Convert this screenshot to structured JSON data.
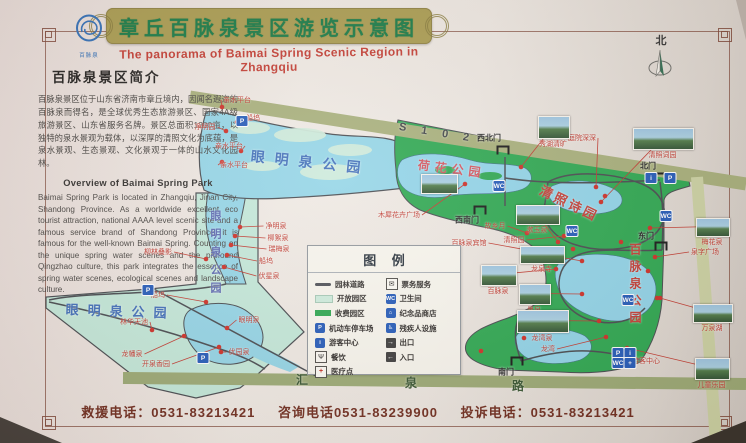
{
  "title": {
    "cn": "章丘百脉泉景区游览示意图",
    "en": "The panorama of Baimai Spring Scenic Region in Zhangqiu"
  },
  "logo": {
    "text": "百脉泉"
  },
  "compass": {
    "label": "北"
  },
  "intro": {
    "heading": "百脉泉景区简介",
    "cn_text": "百脉泉景区位于山东省济南市章丘境内，因闻名遐迩的百脉泉而得名，是全球优秀生态旅游景区、国家4A级旅游景区、山东省服务名牌。景区总面积1300亩，以独特的泉水景观为载体，以深厚的清照文化为底蕴，是泉水景观、生态景观、文化景观于一体的山水文化园林。",
    "en_heading": "Overview of Baimai Spring Park",
    "en_text": "Baimai Spring Park is located in Zhangqiu, Jinan City, Shandong Province. As a worldwide excellent eco tourist attraction, national AAAA level scenic site and a famous service brand of Shandong Province, it is famous for the well-known Baimai Spring. Counting on the unique spring water scenes and the profound Qingzhao culture, this park integrates the essence of spring water scenes, ecological scenes and landscape culture."
  },
  "legend": {
    "title": "图 例",
    "left": [
      {
        "icon": "garden-road-icon",
        "kind": "road",
        "glyph": "",
        "label": "园林道路"
      },
      {
        "icon": "open-area-icon",
        "kind": "open",
        "glyph": "",
        "label": "开放园区"
      },
      {
        "icon": "paid-area-icon",
        "kind": "paid",
        "glyph": "",
        "label": "收费园区"
      },
      {
        "icon": "parking-icon",
        "kind": "blue",
        "glyph": "P",
        "label": "机动车停车场"
      },
      {
        "icon": "visitor-center-icon",
        "kind": "blue",
        "glyph": "i",
        "label": "游客中心"
      },
      {
        "icon": "food-icon",
        "kind": "plain",
        "glyph": "Ψ",
        "label": "餐饮"
      },
      {
        "icon": "medical-icon",
        "kind": "plain med",
        "glyph": "+",
        "label": "医疗点"
      }
    ],
    "right": [
      {
        "icon": "ticket-icon",
        "kind": "plain",
        "glyph": "✉",
        "label": "票务服务"
      },
      {
        "icon": "toilet-icon",
        "kind": "blue",
        "glyph": "WC",
        "label": "卫生间"
      },
      {
        "icon": "souvenir-shop-icon",
        "kind": "blue",
        "glyph": "⌂",
        "label": "纪念品商店"
      },
      {
        "icon": "accessible-icon",
        "kind": "blue",
        "glyph": "♿",
        "label": "残疾人设施"
      },
      {
        "icon": "exit-icon",
        "kind": "door",
        "glyph": "→",
        "label": "出口"
      },
      {
        "icon": "entrance-icon",
        "kind": "door",
        "glyph": "←",
        "label": "入口"
      }
    ]
  },
  "map": {
    "texts": [
      {
        "t": "眼明泉公园",
        "x": 252,
        "y": 146,
        "size": 14,
        "color": "#3f6db8",
        "sp": 10,
        "rot": 6
      },
      {
        "t": "眼明泉公园",
        "x": 207,
        "y": 210,
        "size": 11,
        "color": "#5a67b0",
        "sp": 7,
        "vert": true
      },
      {
        "t": "眼明泉公园",
        "x": 66,
        "y": 299,
        "size": 13,
        "color": "#3f6db8",
        "sp": 9,
        "rot": 2
      },
      {
        "t": "荷花公园",
        "x": 419,
        "y": 156,
        "size": 12,
        "color": "#d4525c",
        "sp": 5,
        "rot": 7
      },
      {
        "t": "清照诗园",
        "x": 545,
        "y": 180,
        "size": 13,
        "color": "#c23b33",
        "sp": 3,
        "rot": 26
      },
      {
        "t": "百脉泉公园",
        "x": 627,
        "y": 243,
        "size": 12,
        "color": "#c23b33",
        "sp": 5,
        "vert": true
      },
      {
        "t": "S 1 0 2",
        "x": 400,
        "y": 121,
        "size": 11,
        "color": "#3e4245",
        "sp": 6,
        "rot": 9
      },
      {
        "t": "汇",
        "x": 296,
        "y": 371,
        "size": 12,
        "color": "#34522e"
      },
      {
        "t": "泉",
        "x": 405,
        "y": 374,
        "size": 12,
        "color": "#34522e"
      },
      {
        "t": "路",
        "x": 512,
        "y": 377,
        "size": 12,
        "color": "#34522e"
      }
    ],
    "gates": [
      {
        "label": "西北门",
        "x": 503,
        "y": 150,
        "lx": 489,
        "ly": 138
      },
      {
        "label": "北门",
        "x": 662,
        "y": 177,
        "lx": 648,
        "ly": 166
      },
      {
        "label": "东门",
        "x": 661,
        "y": 246,
        "lx": 646,
        "ly": 236
      },
      {
        "label": "西南门",
        "x": 480,
        "y": 210,
        "lx": 467,
        "ly": 220
      },
      {
        "label": "南门",
        "x": 517,
        "y": 361,
        "lx": 506,
        "ly": 372
      }
    ],
    "spots": [
      {
        "label": "亲水平台",
        "lx": 237,
        "ly": 100,
        "dx": 222,
        "dy": 107
      },
      {
        "label": "船坞",
        "lx": 253,
        "ly": 118,
        "dx": 237,
        "dy": 122
      },
      {
        "label": "净明园",
        "lx": 205,
        "ly": 127,
        "dx": 226,
        "dy": 131
      },
      {
        "label": "亲水平台",
        "lx": 229,
        "ly": 146,
        "dx": 241,
        "dy": 151
      },
      {
        "label": "亲水平台",
        "lx": 234,
        "ly": 165,
        "dx": 222,
        "dy": 162
      },
      {
        "label": "净明泉",
        "lx": 276,
        "ly": 226,
        "dx": 240,
        "dy": 227
      },
      {
        "label": "柳絮泉",
        "lx": 278,
        "ly": 238,
        "dx": 235,
        "dy": 236
      },
      {
        "label": "瑞梅泉",
        "lx": 279,
        "ly": 249,
        "dx": 231,
        "dy": 245
      },
      {
        "label": "船坞",
        "lx": 266,
        "ly": 261,
        "dx": 227,
        "dy": 255
      },
      {
        "label": "伏星泉",
        "lx": 269,
        "ly": 276,
        "dx": 224,
        "dy": 267
      },
      {
        "label": "柳林叠影",
        "lx": 158,
        "ly": 252,
        "dx": 206,
        "dy": 259
      },
      {
        "label": "船坞",
        "lx": 158,
        "ly": 295,
        "dx": 206,
        "dy": 302
      },
      {
        "label": "林华天池",
        "lx": 134,
        "ly": 322,
        "dx": 152,
        "dy": 330
      },
      {
        "label": "眼明泉",
        "lx": 249,
        "ly": 320,
        "dx": 227,
        "dy": 328
      },
      {
        "label": "龙幡泉",
        "lx": 132,
        "ly": 354,
        "dx": 184,
        "dy": 336
      },
      {
        "label": "开泉香园",
        "lx": 156,
        "ly": 364,
        "dx": 219,
        "dy": 347
      },
      {
        "label": "优园泉",
        "lx": 239,
        "ly": 352,
        "dx": 221,
        "dy": 352
      },
      {
        "label": "木犀花卉广场",
        "lx": 399,
        "ly": 215,
        "dx": 465,
        "dy": 184
      },
      {
        "label": "故乡月",
        "lx": 495,
        "ly": 226,
        "dx": 527,
        "dy": 233
      },
      {
        "label": "清照园",
        "lx": 514,
        "ly": 240,
        "dx": 564,
        "dy": 236
      },
      {
        "label": "百脉泉宾馆",
        "lx": 469,
        "ly": 243,
        "dx": 538,
        "dy": 252
      },
      {
        "label": "庭院深深",
        "lx": 582,
        "ly": 138,
        "dx": 596,
        "dy": 187
      },
      {
        "label": "泉字广场",
        "lx": 705,
        "ly": 252,
        "dx": 655,
        "dy": 257
      },
      {
        "label": "龙湾",
        "lx": 548,
        "ly": 349,
        "dx": 606,
        "dy": 337
      },
      {
        "label": "游客中心",
        "lx": 646,
        "ly": 361,
        "dx": 617,
        "dy": 355
      }
    ],
    "photos": [
      {
        "x": 421,
        "y": 174,
        "w": 35,
        "h": 18
      },
      {
        "label": "秀湖清旷",
        "x": 538,
        "y": 116,
        "w": 30,
        "h": 21,
        "dx": 521,
        "dy": 167
      },
      {
        "label": "清照词园",
        "x": 633,
        "y": 128,
        "w": 59,
        "h": 20,
        "dx": 601,
        "dy": 202
      },
      {
        "label": "梅花泉",
        "x": 696,
        "y": 218,
        "w": 32,
        "h": 17,
        "dx": 650,
        "dy": 228
      },
      {
        "label": "万泉湖",
        "x": 693,
        "y": 304,
        "w": 38,
        "h": 17,
        "dx": 660,
        "dy": 298
      },
      {
        "label": "儿童乐园",
        "x": 695,
        "y": 358,
        "w": 33,
        "h": 20,
        "dx": 627,
        "dy": 348
      },
      {
        "label": "漱玉泉",
        "x": 516,
        "y": 205,
        "w": 42,
        "h": 18,
        "dx": 558,
        "dy": 242
      },
      {
        "label": "龙泉寺",
        "x": 520,
        "y": 246,
        "w": 43,
        "h": 16,
        "dx": 582,
        "dy": 261
      },
      {
        "label": "百脉泉",
        "x": 481,
        "y": 265,
        "w": 34,
        "h": 19,
        "dx": 556,
        "dy": 269
      },
      {
        "label": "墨泉",
        "x": 519,
        "y": 284,
        "w": 30,
        "h": 19,
        "dx": 582,
        "dy": 294
      },
      {
        "label": "龙湾泉",
        "x": 517,
        "y": 310,
        "w": 50,
        "h": 21,
        "dx": 599,
        "dy": 321
      }
    ],
    "icons": [
      {
        "g": "P",
        "x": 148,
        "y": 290
      },
      {
        "g": "P",
        "x": 203,
        "y": 358
      },
      {
        "g": "P",
        "x": 242,
        "y": 121
      },
      {
        "g": "P",
        "x": 670,
        "y": 178
      },
      {
        "g": "i",
        "x": 651,
        "y": 178
      },
      {
        "g": "WC",
        "x": 499,
        "y": 186
      },
      {
        "g": "WC",
        "x": 572,
        "y": 231
      },
      {
        "g": "WC",
        "x": 666,
        "y": 216
      },
      {
        "g": "WC",
        "x": 628,
        "y": 300
      },
      {
        "g": "P",
        "x": 618,
        "y": 353
      },
      {
        "g": "i",
        "x": 630,
        "y": 353
      },
      {
        "g": "WC",
        "x": 618,
        "y": 363
      },
      {
        "g": "+",
        "x": 630,
        "y": 363
      }
    ],
    "dots": [
      [
        605,
        196
      ],
      [
        621,
        242
      ],
      [
        573,
        249
      ],
      [
        648,
        271
      ],
      [
        657,
        298
      ],
      [
        562,
        330
      ],
      [
        481,
        351
      ],
      [
        524,
        338
      ]
    ]
  },
  "footer": {
    "rescue": "救援电话：0531-83213421",
    "consult": "咨询电话0531-83239900",
    "complaint": "投诉电话：0531-83213421"
  }
}
